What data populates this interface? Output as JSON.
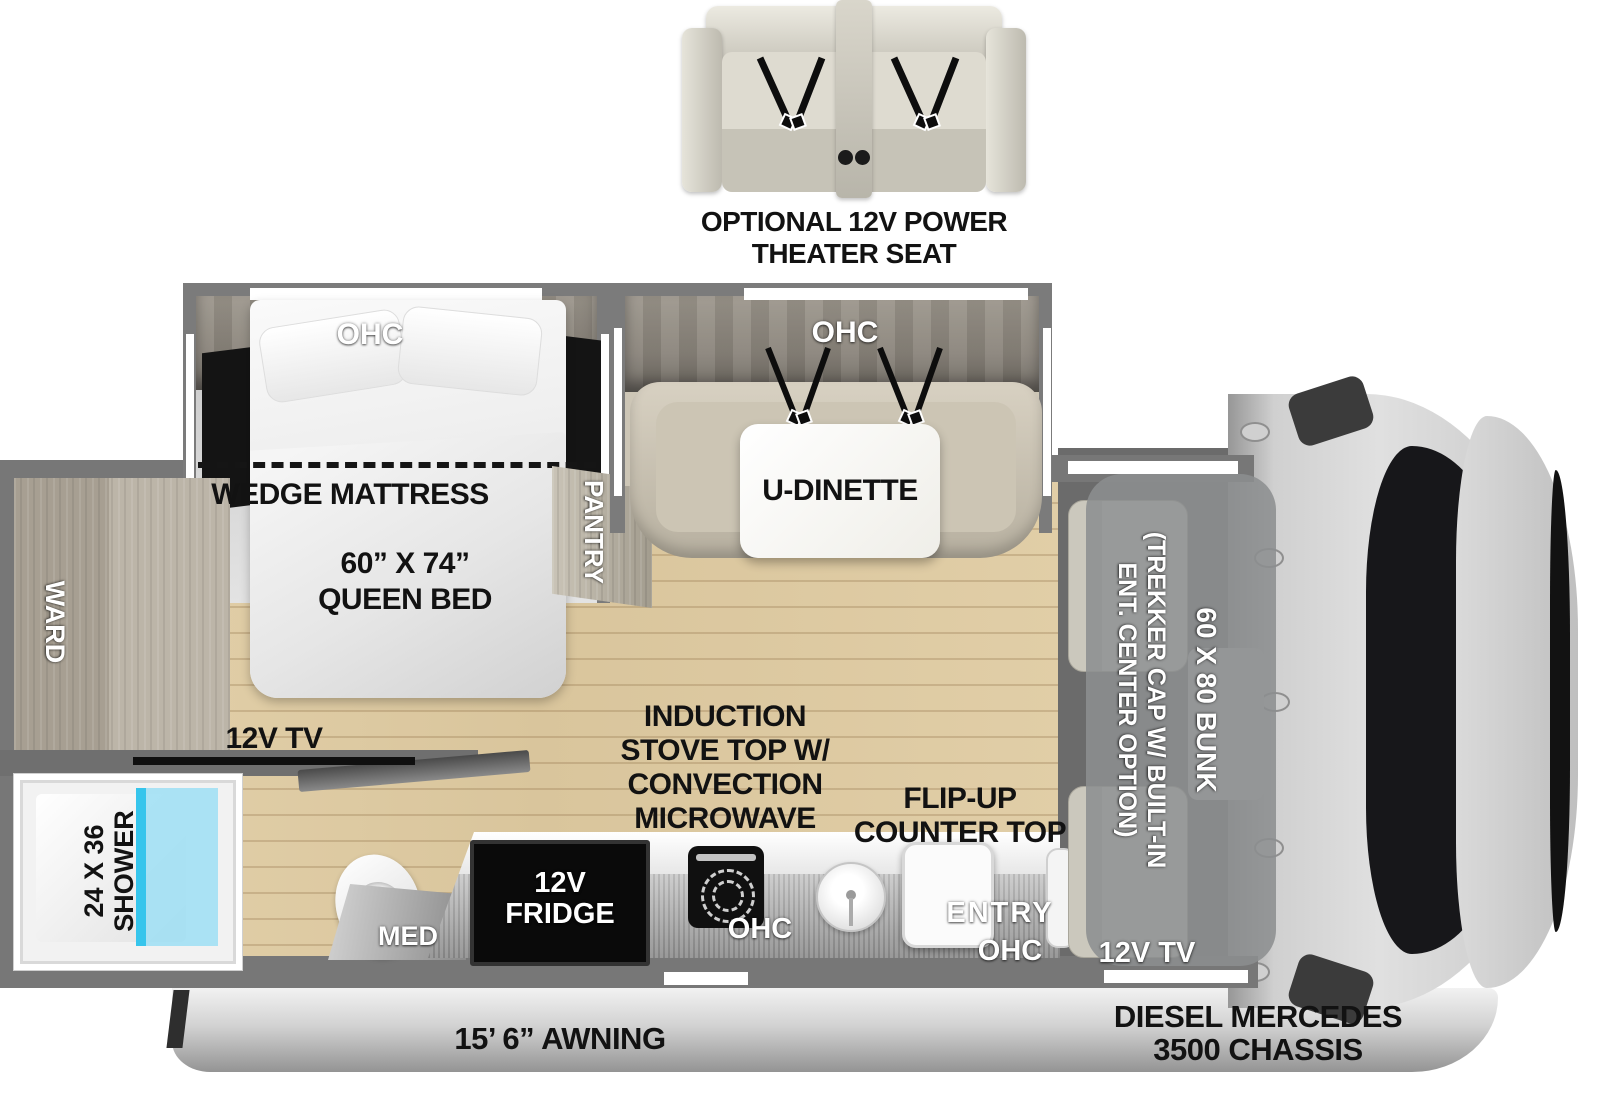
{
  "theater_seat": {
    "caption_line1": "OPTIONAL 12V POWER",
    "caption_line2": "THEATER SEAT"
  },
  "slides": {
    "bedroom_ohc": "OHC",
    "dinette_ohc": "OHC"
  },
  "bedroom": {
    "wedge_mattress": "WEDGE MATTRESS",
    "bed_size": "60” X 74”",
    "bed_type": "QUEEN BED",
    "tv": "12V TV",
    "ward": "WARD",
    "pantry": "PANTRY"
  },
  "dinette": {
    "label": "U-DINETTE"
  },
  "bathroom": {
    "shower_size": "24 X 36",
    "shower_label": "SHOWER",
    "med": "MED"
  },
  "kitchen": {
    "fridge_line1": "12V",
    "fridge_line2": "FRIDGE",
    "ohc": "OHC",
    "stove_line1": "INDUCTION",
    "stove_line2": "STOVE TOP W/",
    "stove_line3": "CONVECTION",
    "stove_line4": "MICROWAVE",
    "flip_up_line1": "FLIP-UP",
    "flip_up_line2": "COUNTER TOP"
  },
  "entry": {
    "label": "ENTRY",
    "ohc": "OHC"
  },
  "cab": {
    "bunk_label": "60 X 80 BUNK",
    "cap_line1": "(TREKKER CAP W/ BUILT-IN",
    "cap_line2": "ENT. CENTER OPTION)",
    "tv": "12V TV"
  },
  "exterior": {
    "awning": "15’ 6” AWNING",
    "chassis_line1": "DIESEL MERCEDES",
    "chassis_line2": "3500 CHASSIS"
  },
  "colors": {
    "wall": "#777777",
    "floor_wood": "#dfcca5",
    "cabinet_wood": "#b3ac9f",
    "shower_glass": "#36c5ec",
    "bench": "#cdc6b6",
    "label_black": "#121212",
    "label_white": "#ffffff"
  }
}
